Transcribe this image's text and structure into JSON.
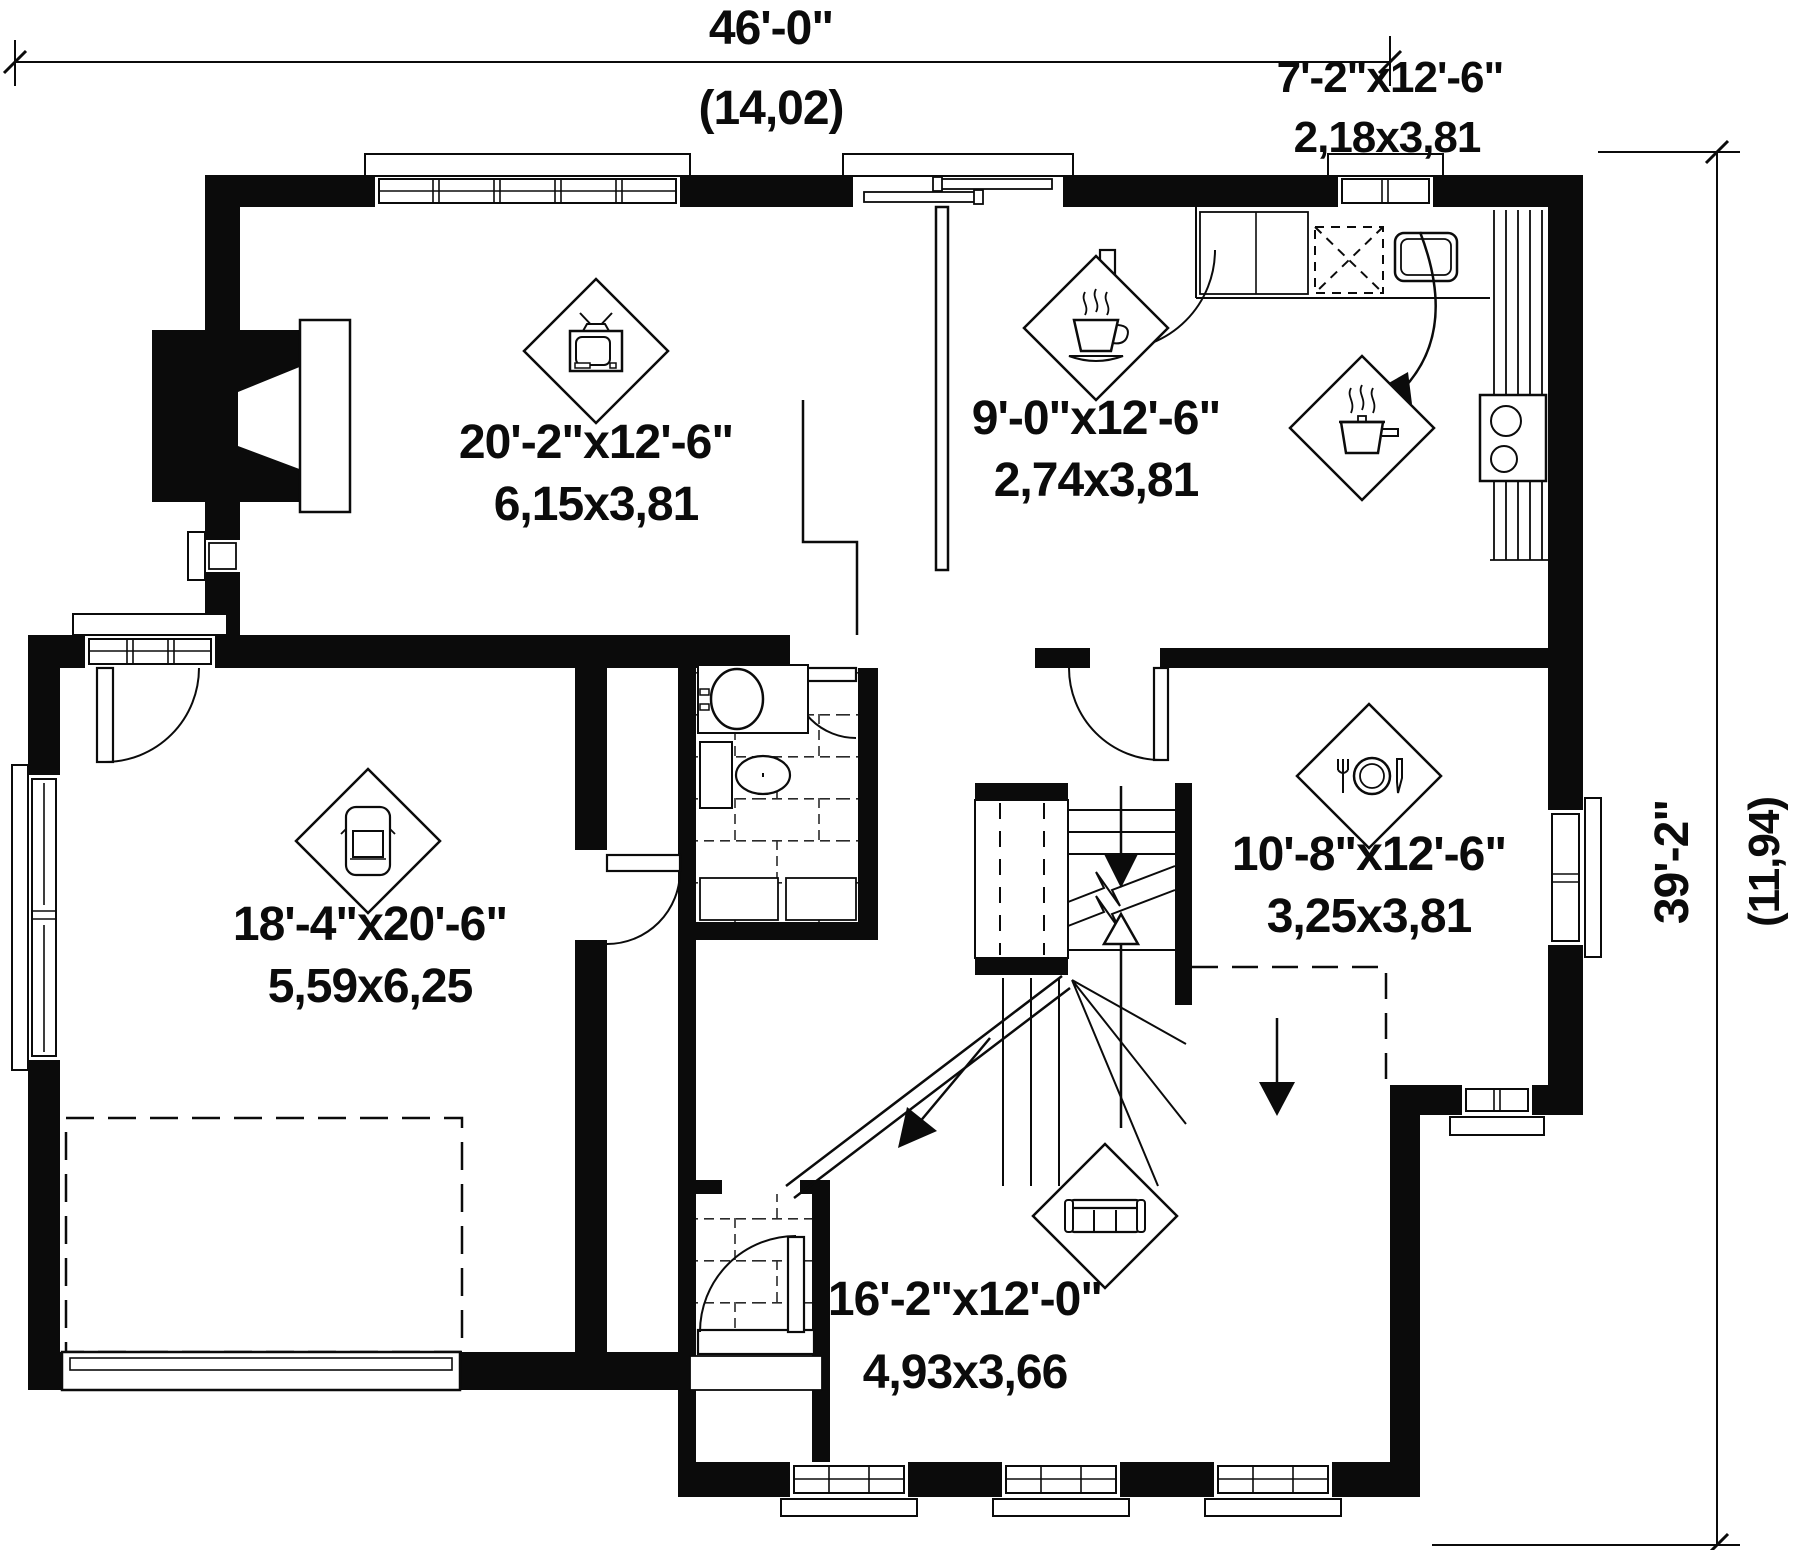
{
  "document": {
    "type": "architectural floor plan",
    "style": "black and white CAD drawing, first floor"
  },
  "dimensions": {
    "overall_width": {
      "imperial": "46'-0\"",
      "metric": "(14,02)"
    },
    "overall_depth": {
      "imperial": "39'-2\"",
      "metric": "(11,94)"
    }
  },
  "rooms": [
    {
      "id": "family-room",
      "icon": "tv-icon",
      "imperial": "20'-2\"x12'-6\"",
      "metric": "6,15x3,81"
    },
    {
      "id": "breakfast",
      "icon": "coffee-cup-icon",
      "imperial": "9'-0\"x12'-6\"",
      "metric": "2,74x3,81"
    },
    {
      "id": "kitchen",
      "icon": "cooking-pot-icon",
      "imperial": "7'-2\"x12'-6\"",
      "metric": "2,18x3,81"
    },
    {
      "id": "garage",
      "icon": "car-icon",
      "imperial": "18'-4\"x20'-6\"",
      "metric": "5,59x6,25"
    },
    {
      "id": "dining-room",
      "icon": "plate-cutlery-icon",
      "imperial": "10'-8\"x12'-6\"",
      "metric": "3,25x3,81"
    },
    {
      "id": "living-room",
      "icon": "sofa-icon",
      "imperial": "16'-2\"x12'-0\"",
      "metric": "4,93x3,66"
    }
  ],
  "colors": {
    "ink": "#0b0b0b",
    "paper": "#ffffff"
  }
}
